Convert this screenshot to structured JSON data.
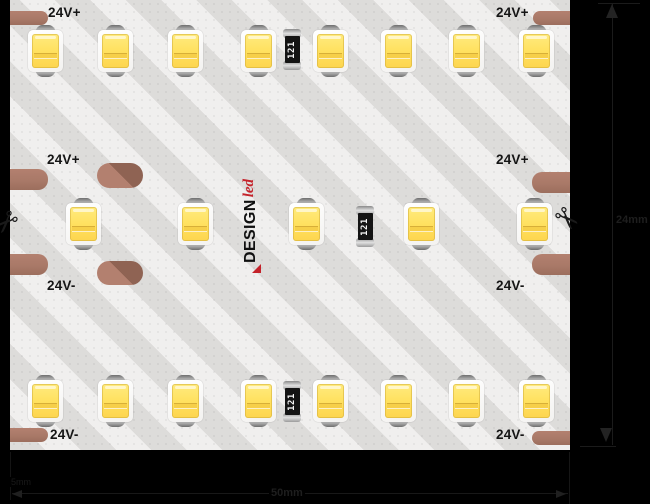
{
  "strip": {
    "positive_label": "24V+",
    "negative_label": "24V-",
    "resistor_code": "121",
    "logo": {
      "brand": "DESIGN",
      "suffix": "led"
    },
    "colors": {
      "pcb": "#f0efee",
      "solder_pad": "#ab7a69",
      "led_chip": "#ffe160",
      "logo_red": "#c4222a",
      "background": "#000000"
    }
  },
  "icons": {
    "scissors": "✂"
  },
  "dimensions": {
    "width_label": "24mm",
    "cut_length_label": "50mm",
    "pitch_label": "5mm"
  }
}
